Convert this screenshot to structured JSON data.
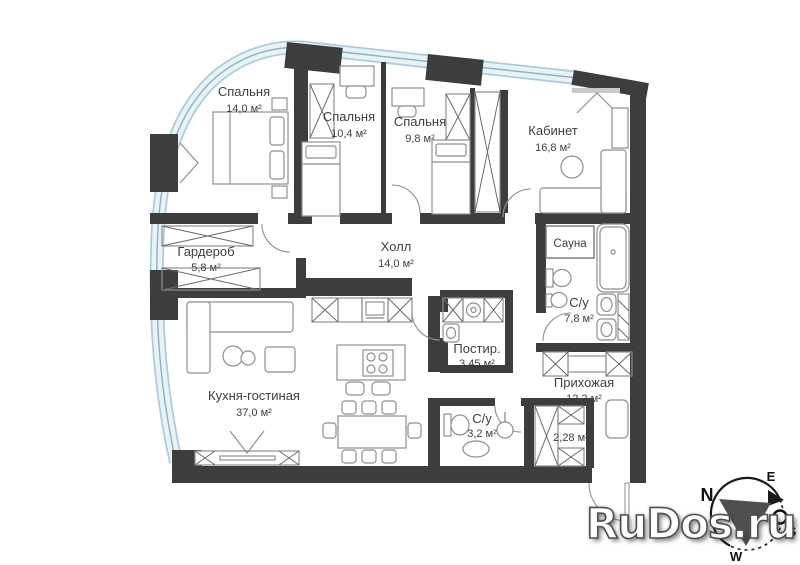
{
  "plan_title": "apartment-floor-plan",
  "rooms": [
    {
      "id": "bedroom-1",
      "name": "Спальня",
      "area": "14,0 м²"
    },
    {
      "id": "bedroom-2",
      "name": "Спальня",
      "area": "10,4 м²"
    },
    {
      "id": "bedroom-3",
      "name": "Спальня",
      "area": "9,8 м²"
    },
    {
      "id": "study",
      "name": "Кабинет",
      "area": "16,8 м²"
    },
    {
      "id": "wardrobe",
      "name": "Гардероб",
      "area": "5,8 м²"
    },
    {
      "id": "hall",
      "name": "Холл",
      "area": "14,0 м²"
    },
    {
      "id": "sauna",
      "name": "Сауна",
      "area": ""
    },
    {
      "id": "bathroom-main",
      "name": "С/у",
      "area": "7,8 м²"
    },
    {
      "id": "laundry",
      "name": "Постир.",
      "area": "3,45 м²"
    },
    {
      "id": "kitchen-living",
      "name": "Кухня-гостиная",
      "area": "37,0 м²"
    },
    {
      "id": "entry-hall",
      "name": "Прихожая",
      "area": "12,2 м²"
    },
    {
      "id": "bathroom-guest",
      "name": "С/у",
      "area": "3,2 м²"
    },
    {
      "id": "storage",
      "name": "",
      "area": "2,28 м²"
    }
  ],
  "compass": {
    "n": "N",
    "e": "E",
    "s": "S",
    "w": "W"
  },
  "watermark": {
    "text": "RuDos.ru"
  },
  "colors": {
    "wall": "#3d3d3d",
    "glass_band": "#e7f3f9",
    "glass_edge": "#aecbd8",
    "label_text": "#3f3f3f",
    "watermark_fill": "#ffffff",
    "compass_needle": "#4f4f4f"
  }
}
